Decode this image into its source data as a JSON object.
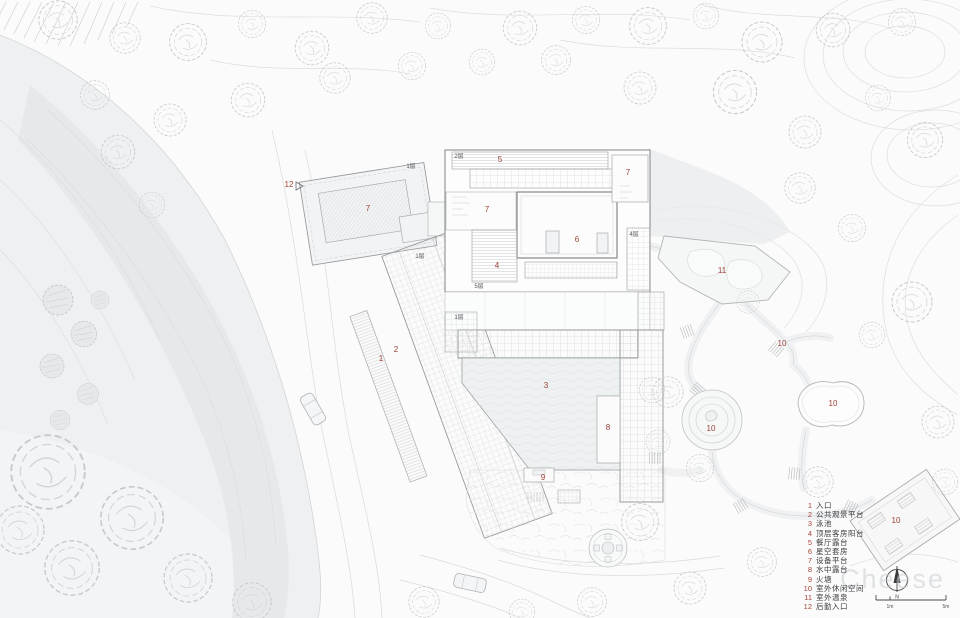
{
  "legend": {
    "items": [
      {
        "num": "1",
        "label": "入口"
      },
      {
        "num": "2",
        "label": "公共观景平台"
      },
      {
        "num": "3",
        "label": "泳池"
      },
      {
        "num": "4",
        "label": "顶层客房阳台"
      },
      {
        "num": "5",
        "label": "餐厅露台"
      },
      {
        "num": "6",
        "label": "星空套房"
      },
      {
        "num": "7",
        "label": "设备平台"
      },
      {
        "num": "8",
        "label": "水中露台"
      },
      {
        "num": "9",
        "label": "火塘"
      },
      {
        "num": "10",
        "label": "室外休闲空间"
      },
      {
        "num": "11",
        "label": "室外温泉"
      },
      {
        "num": "12",
        "label": "后勤入口"
      }
    ]
  },
  "plan_labels": [
    "1",
    "2",
    "3",
    "4",
    "5",
    "6",
    "7",
    "7",
    "7",
    "8",
    "9",
    "10",
    "10",
    "10",
    "10",
    "11",
    "12"
  ],
  "floor_labels": [
    "2层",
    "1层",
    "1层",
    "1层",
    "5层",
    "4层"
  ],
  "north": {
    "label": "N"
  },
  "scale": {
    "tick_mid": "1m",
    "tick_end": "5m"
  },
  "watermark": {
    "text": "Cheese"
  },
  "colors": {
    "label_red": "#9c4136",
    "line_gray": "#a8abad",
    "water_gray": "#e6e9ea",
    "paper": "#fbfbfb"
  }
}
